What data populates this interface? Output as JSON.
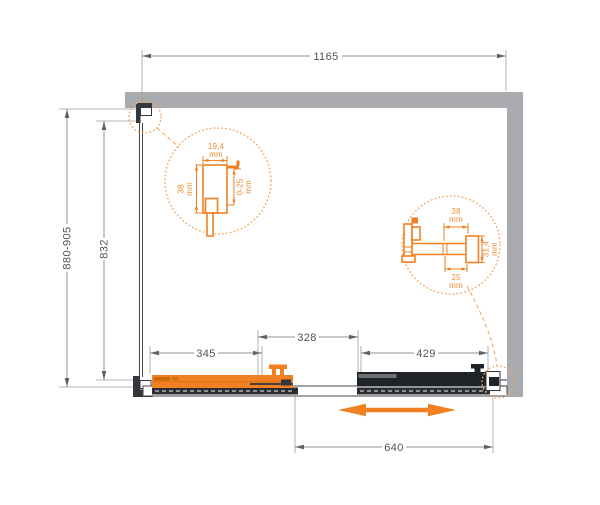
{
  "dimensions": {
    "width_total": "1165",
    "height_range": "880-905",
    "glass_height": "832",
    "door_panel": "345",
    "overlap": "328",
    "fixed_panel": "429",
    "slide_travel": "640"
  },
  "detail_left": {
    "profile_width": "19,4",
    "profile_width_unit": "mm",
    "profile_depth": "38",
    "profile_depth_unit": "mm",
    "adjustment": "0-25",
    "adjustment_unit": "mm"
  },
  "detail_right": {
    "rail_width": "38",
    "rail_width_unit": "mm",
    "glass_offset": "25",
    "glass_offset_unit": "mm",
    "rail_height": "31,4",
    "rail_height_unit": "mm"
  },
  "icons": {
    "slide_direction": "horizontal-double-arrow"
  },
  "colors": {
    "accent_orange": "#F08021",
    "accent_orange_light": "#F2A45C",
    "wall_gray": "#A9ABAE",
    "line_dark": "#33363B",
    "panel_black": "#202327",
    "dim_line_gray": "#8F9296",
    "dim_text_gray": "#515458"
  }
}
